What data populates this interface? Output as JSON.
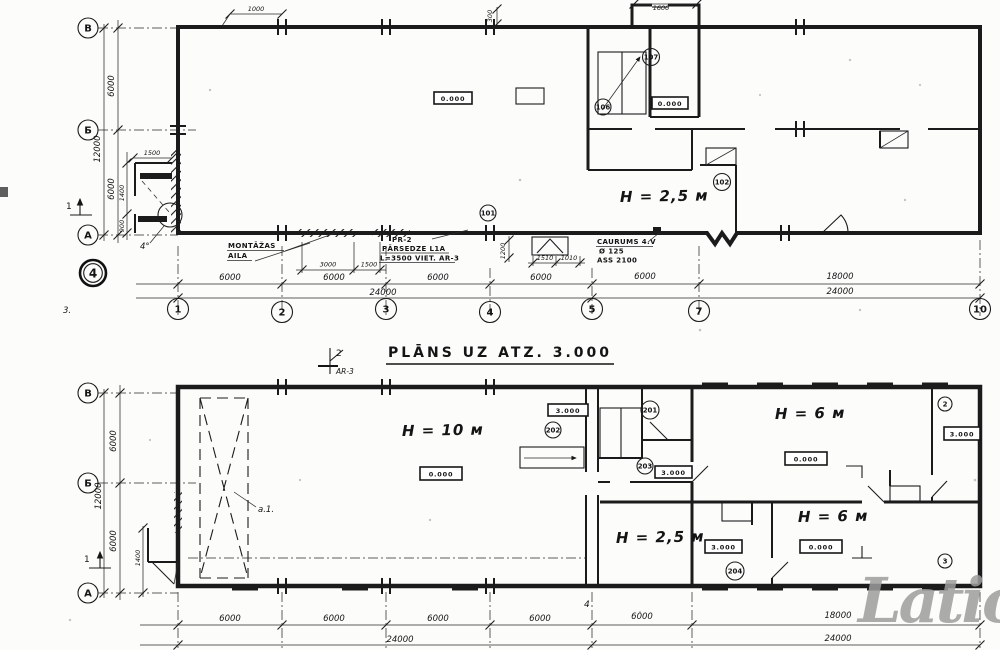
{
  "watermark": "Latio",
  "title": {
    "text": "PLĀNS UZ ATZ. 3.000",
    "cut_number": "2",
    "cut_sheet": "AR-3"
  },
  "upper_plan": {
    "grid_rows": [
      "В",
      "Б",
      "А"
    ],
    "grid_cols": [
      "1",
      "2",
      "3",
      "4",
      "5",
      "7",
      "10"
    ],
    "dim_left_span1": "6000",
    "dim_left_span2": "6000",
    "dim_left_total": "12000",
    "dim_bottom_spans": [
      "6000",
      "6000",
      "6000",
      "6000"
    ],
    "dim_bottom_total_left": "24000",
    "dim_bottom_span_5_7": "6000",
    "dim_bottom_span_7_10": "18000",
    "dim_bottom_total_right": "24000",
    "dim_top_bay": "1000",
    "dim_top_wall": "300",
    "dim_vestibule": "1600",
    "dim_annex_width": "1500",
    "dim_annex_h1": "1400",
    "dim_annex_h2": "900",
    "dim_montage_1": "3000",
    "dim_montage_2": "1500",
    "dim_entry_1": "1510",
    "dim_entry_2": "1010",
    "dim_entry_v": "1200",
    "height_label": "H = 2,5 м",
    "elev_hall": "0.000",
    "elev_lobby": "0.000",
    "room_107": "107",
    "room_106": "106",
    "room_102": "102",
    "room_101": "101",
    "note_montage_1": "MONTĀŽAS",
    "note_montage_2": "AILA",
    "note_pr_1": "PR-2",
    "note_pr_2": "PĀRSEDZE L1A",
    "note_pr_3": "L=3500 VIET. AR-3",
    "note_hole_1": "CAURUMS 4.V",
    "note_hole_2": "Ø 125",
    "note_hole_3": "ASS 2100",
    "sheet_stamp": "4",
    "corner_mark": "3.",
    "section_arrow": "1",
    "detail_mark": "4°"
  },
  "lower_plan": {
    "grid_rows": [
      "В",
      "Б",
      "А"
    ],
    "dim_left_span1": "6000",
    "dim_left_span2": "6000",
    "dim_left_total": "12000",
    "dim_annex": "1400",
    "dim_bottom_spans": [
      "6000",
      "6000",
      "6000",
      "6000"
    ],
    "dim_bottom_total_left": "24000",
    "dim_bottom_span_5_7": "6000",
    "dim_bottom_span_7_10": "18000",
    "dim_bottom_total_right": "24000",
    "height_hall": "H = 10 м",
    "height_low": "H = 2,5 м",
    "height_room_tr": "H = 6 м",
    "height_room_br": "H = 6 м",
    "elev_hall": "0.000",
    "elev_stair": "3.000",
    "elev_mid": "3.000",
    "elev_room_tr": "0.000",
    "elev_room_br": "0.000",
    "elev_low": "3.000",
    "elev_right": "3.000",
    "room_201": "201",
    "room_202": "202",
    "room_203": "203",
    "room_204": "204",
    "room_r1": "2",
    "room_r2": "3",
    "crane_label": "a.1.",
    "section_arrow": "1",
    "hand_mark": "4"
  }
}
